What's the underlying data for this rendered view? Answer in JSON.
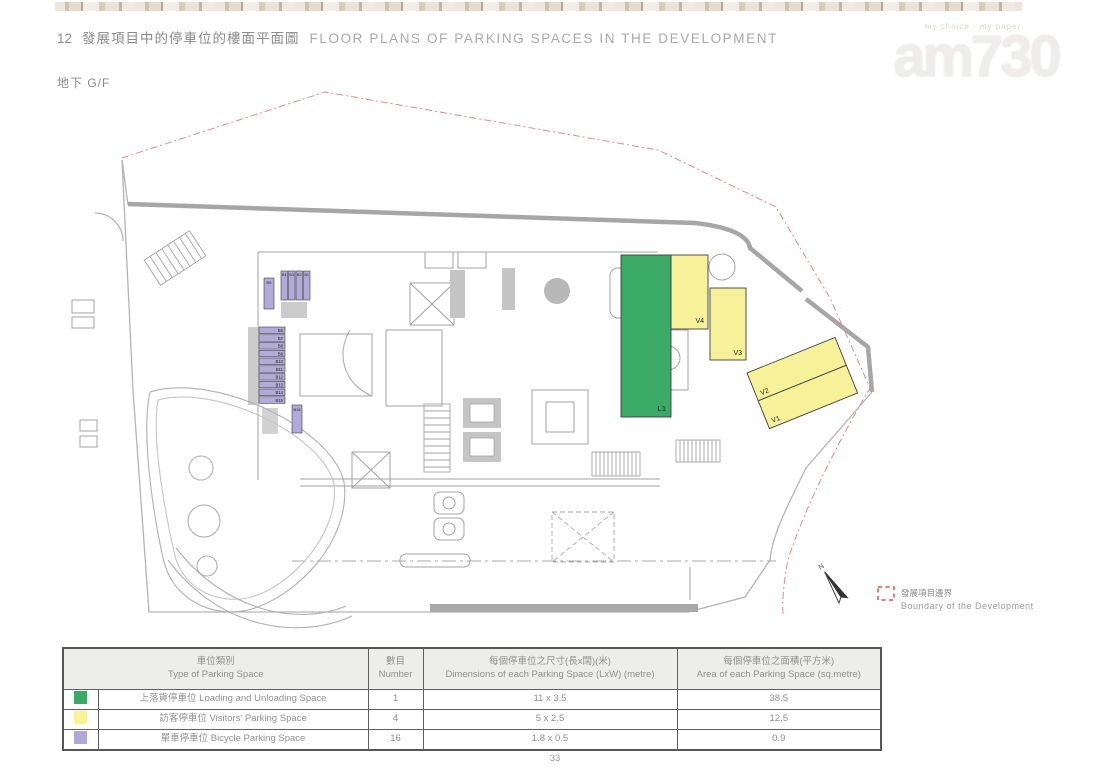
{
  "page": {
    "title": {
      "number": "12",
      "zh": "發展項目中的停車位的樓面平面圖",
      "en": "FLOOR PLANS OF PARKING SPACES IN THE DEVELOPMENT"
    },
    "floor_label": "地下 G/F",
    "page_number": "33"
  },
  "watermark": {
    "tagline": "my choice · my paper",
    "logo": "am730"
  },
  "plan": {
    "north_label": "N",
    "legend": {
      "zh": "發展項目邊界",
      "en": "Boundary of the Development",
      "color": "#d9534f"
    },
    "spaces": {
      "loading": {
        "label": "L1",
        "color": "#3aaa66"
      },
      "visitor": {
        "labels": [
          "V1",
          "V2",
          "V3",
          "V4"
        ],
        "color": "#f7f29a"
      },
      "bicycle": {
        "labels": [
          "B1",
          "B2",
          "B3",
          "B4",
          "B5",
          "B6",
          "B7",
          "B8",
          "B9",
          "B10",
          "B11",
          "B12",
          "B13",
          "B14",
          "B15",
          "B16"
        ],
        "color": "#b2aad8"
      }
    }
  },
  "table": {
    "headers": [
      {
        "zh": "車位類別",
        "en": "Type of Parking Space"
      },
      {
        "zh": "數目",
        "en": "Number"
      },
      {
        "zh": "每個停車位之尺寸(長x闊)(米)",
        "en": "Dimensions of each Parking Space (LxW) (metre)"
      },
      {
        "zh": "每個停車位之面積(平方米)",
        "en": "Area of each Parking Space (sq.metre)"
      }
    ],
    "rows": [
      {
        "swatch": "#3aaa66",
        "type": "上落貨停車位 Loading and Unloading Space",
        "number": "1",
        "dimensions": "11 x 3.5",
        "area": "38.5"
      },
      {
        "swatch": "#f8f39b",
        "type": "訪客停車位 Visitors' Parking Space",
        "number": "4",
        "dimensions": "5 x 2.5",
        "area": "12.5"
      },
      {
        "swatch": "#b0a8d8",
        "type": "單車停車位 Bicycle Parking Space",
        "number": "16",
        "dimensions": "1.8 x 0.5",
        "area": "0.9"
      }
    ]
  }
}
